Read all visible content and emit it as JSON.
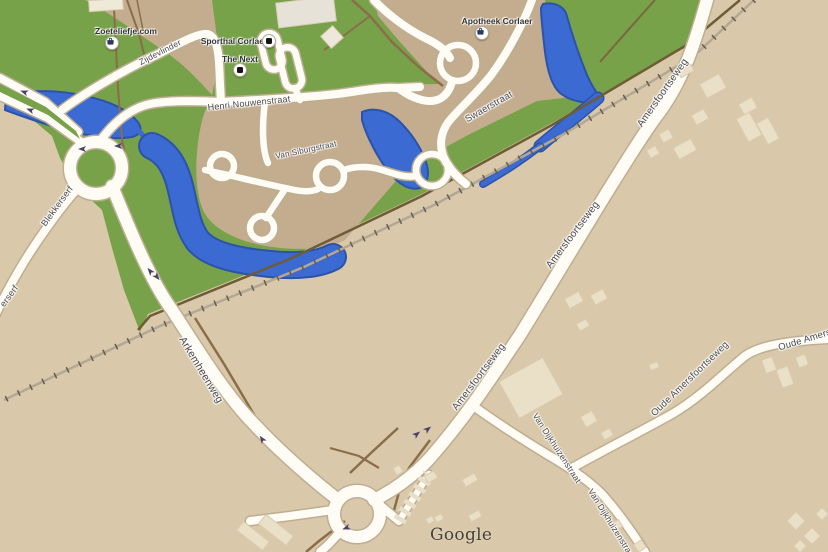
{
  "map": {
    "attribution": "Google",
    "street_labels": [
      {
        "id": "zijdevlinder",
        "text": "Zijdevlinder"
      },
      {
        "id": "henri-nouwenstraat",
        "text": "Henri Nouwenstraat"
      },
      {
        "id": "swaerstraat",
        "text": "Swaerstraat"
      },
      {
        "id": "van-siburgstraat",
        "text": "Van Siburgstraat"
      },
      {
        "id": "blekkerserf",
        "text": "Blekkerserf"
      },
      {
        "id": "blekkerserf-partial",
        "text": "erserf"
      },
      {
        "id": "arkemheenweg",
        "text": "Arkemheenweg"
      },
      {
        "id": "amersfoortseweg-north",
        "text": "Amersfoortseweg"
      },
      {
        "id": "amersfoortseweg-mid",
        "text": "Amersfoortseweg"
      },
      {
        "id": "amersfoortseweg-south",
        "text": "Amersfoortseweg"
      },
      {
        "id": "van-dijkhuizenstraat-1",
        "text": "Van Dijkhuizenstraat"
      },
      {
        "id": "van-dijkhuizenstraat-2",
        "text": "Van Dijkhuizenstraat"
      },
      {
        "id": "oude-amersfoortseweg",
        "text": "Oude Amersfoortseweg"
      },
      {
        "id": "oude-amersfoortseweg-partial",
        "text": "Oude Amersfoortseweg"
      }
    ],
    "poi_labels": [
      {
        "name": "Zoeteliefje.com",
        "icon": "shopping-bag-icon"
      },
      {
        "name": "Sporthal Corlaer",
        "icon": "square-poi-icon"
      },
      {
        "name": "The Next",
        "icon": "square-poi-icon"
      },
      {
        "name": "Apotheek Corlaer",
        "icon": "shopping-bag-icon"
      }
    ],
    "icons": [
      "shopping-bag-icon",
      "square-poi-icon",
      "one-way-arrow-icon"
    ],
    "colors": {
      "field": "#d9c8a9",
      "residential": "#c4ac8e",
      "park": "#78a24a",
      "water": "#3a6ad2",
      "water_edge": "#2d53a8",
      "road_fill": "#fffcf5",
      "road_casing": "#bdae92",
      "railway": "#b3a795",
      "railway_ticks": "#655c4e",
      "dirt_path": "#8a6d49",
      "building": "#eadfc7",
      "street_label": "#474747",
      "poi_label": "#333333",
      "arrow": "#4b4168",
      "watermark": "#453f36"
    }
  }
}
